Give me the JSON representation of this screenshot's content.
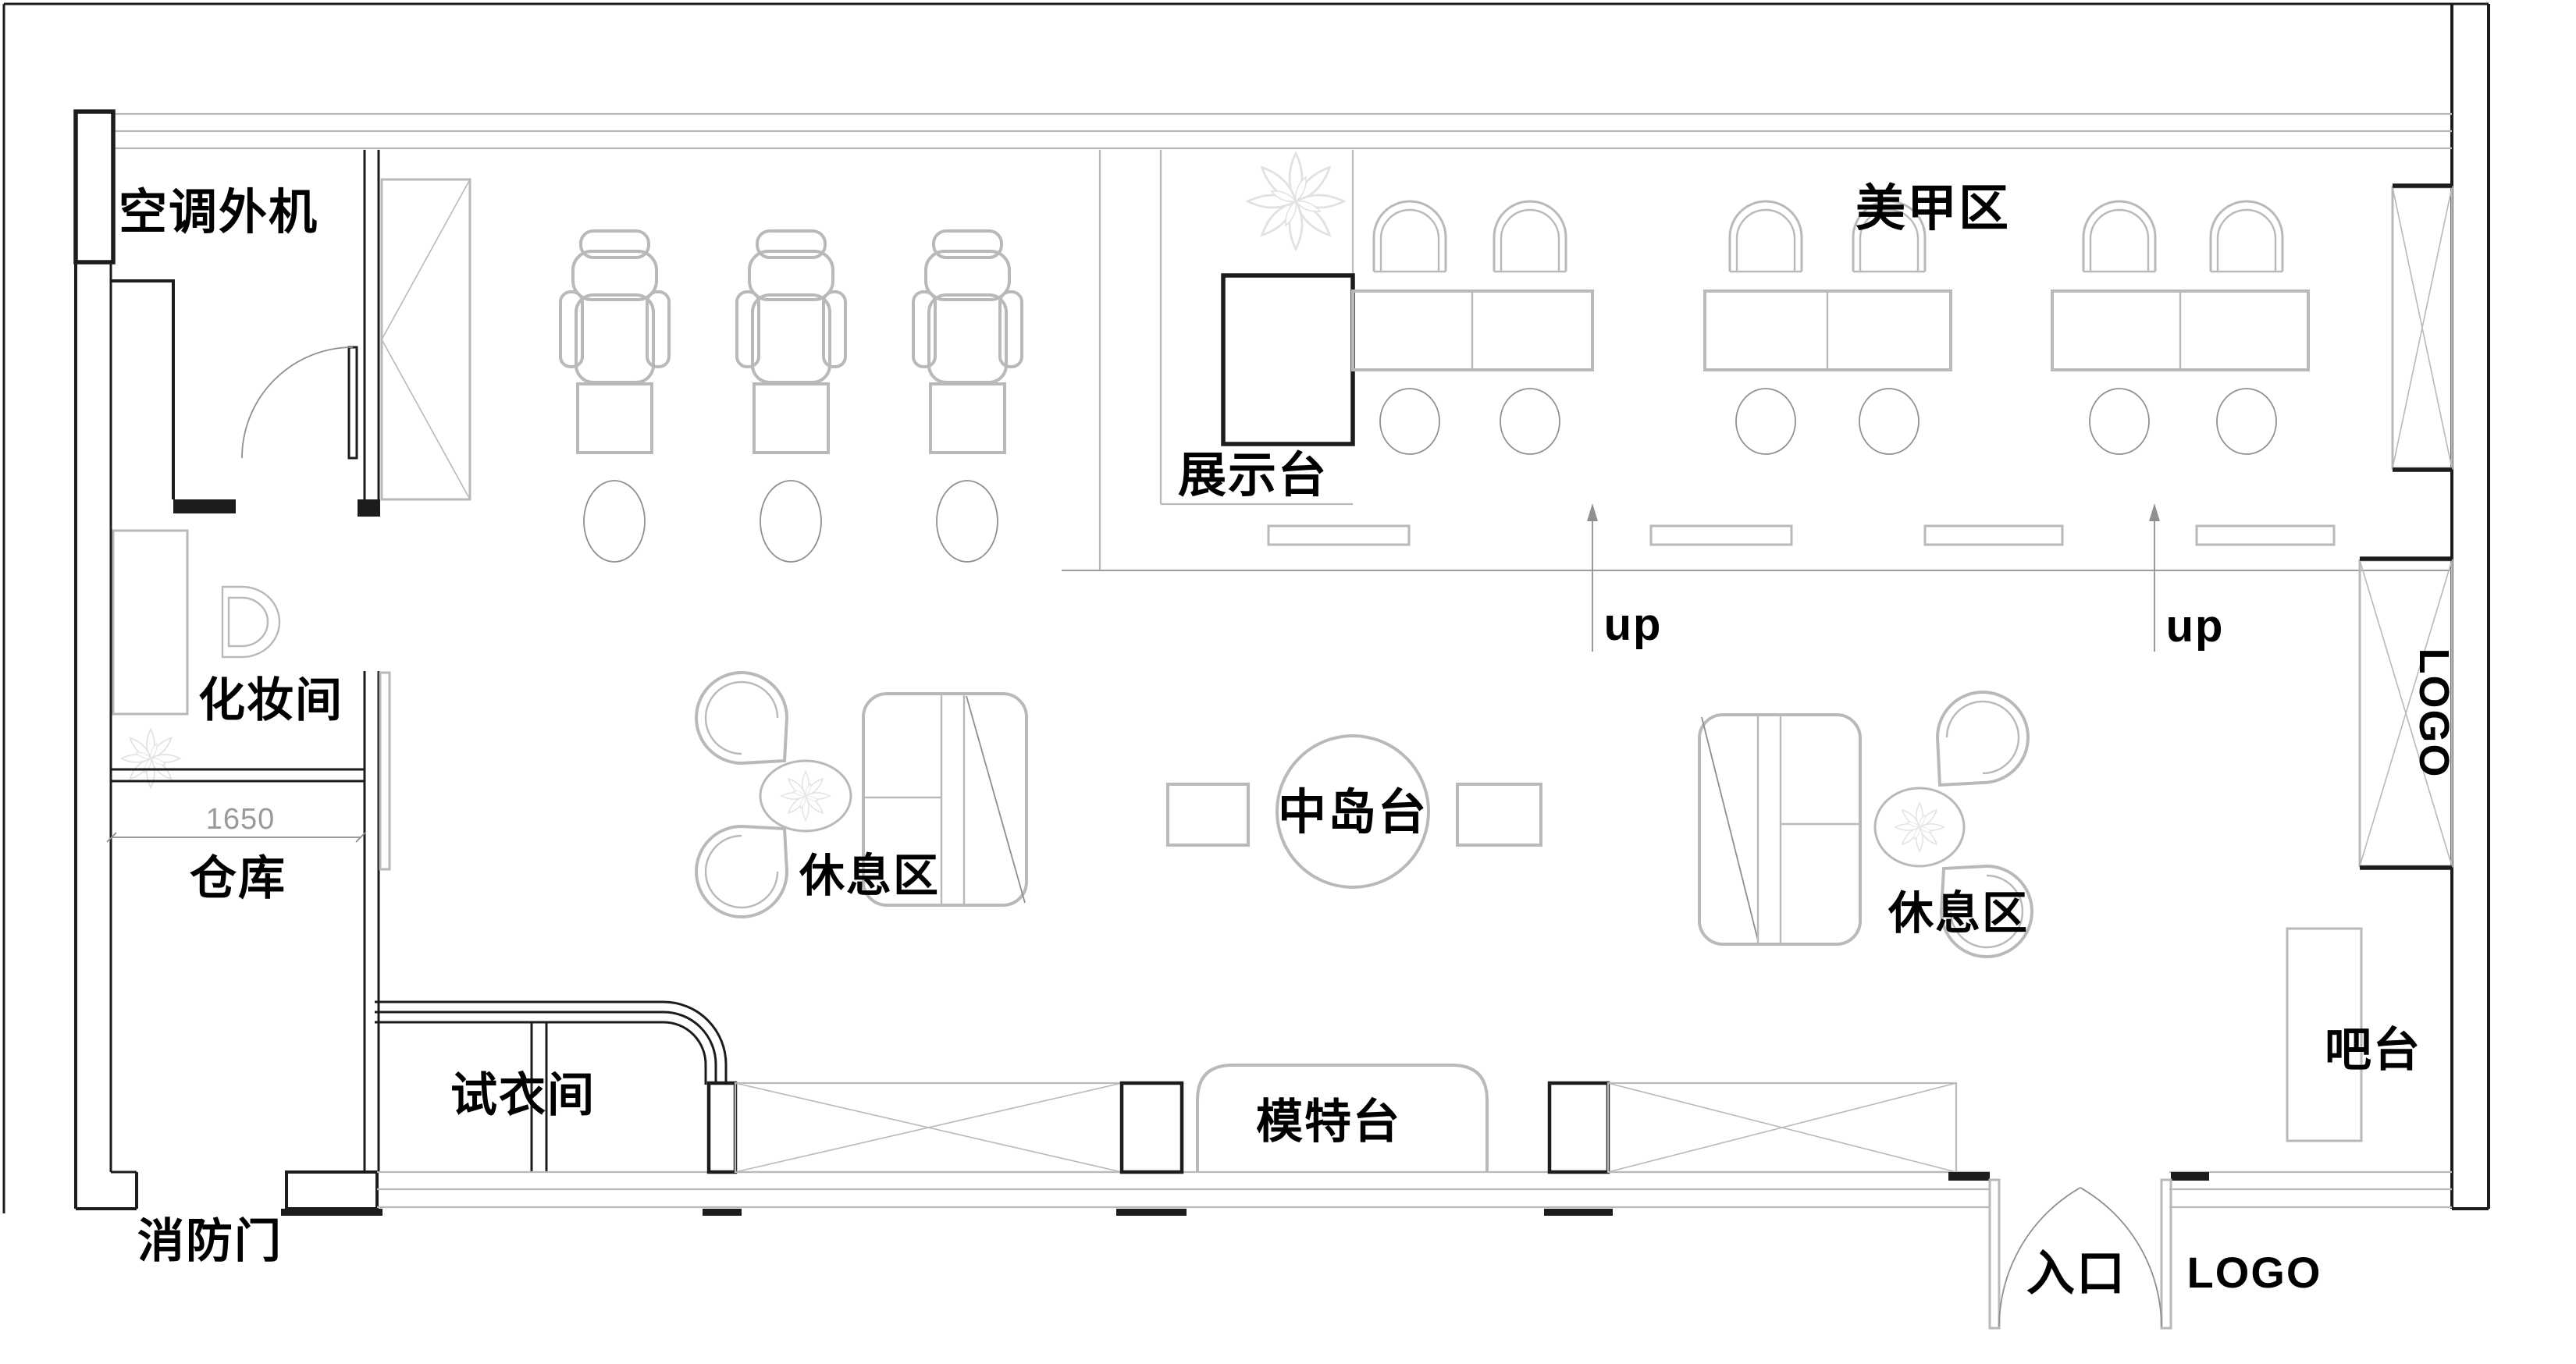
{
  "palette": {
    "wall": "#1c1c1c",
    "furn": "#b9b9b9",
    "thin": "#8f8f8f",
    "decor": "#e2e2e2",
    "ink": "#000000",
    "dimc": "#9a9a9a",
    "paper": "#ffffff"
  },
  "plan": {
    "type": "floorplan",
    "labels": {
      "ac_outdoor_unit": "空调外机",
      "nail_area": "美甲区",
      "display_stand": "展示台",
      "up_left": "up",
      "up_right": "up",
      "makeup_room": "化妆间",
      "storage": "仓库",
      "lounge_left": "休息区",
      "lounge_right": "休息区",
      "center_island": "中岛台",
      "fitting_room": "试衣间",
      "model_stage": "模特台",
      "bar_counter": "吧台",
      "fire_door": "消防门",
      "entrance": "入口",
      "logo_side": "LOGO",
      "logo_front": "LOGO"
    },
    "dimensions": {
      "storage_width": "1650"
    },
    "counts": {
      "styling_chairs": 3,
      "nail_tables": 3,
      "nail_seats": 6,
      "lounge_sets": 2,
      "stair_up_marks": 2
    }
  }
}
